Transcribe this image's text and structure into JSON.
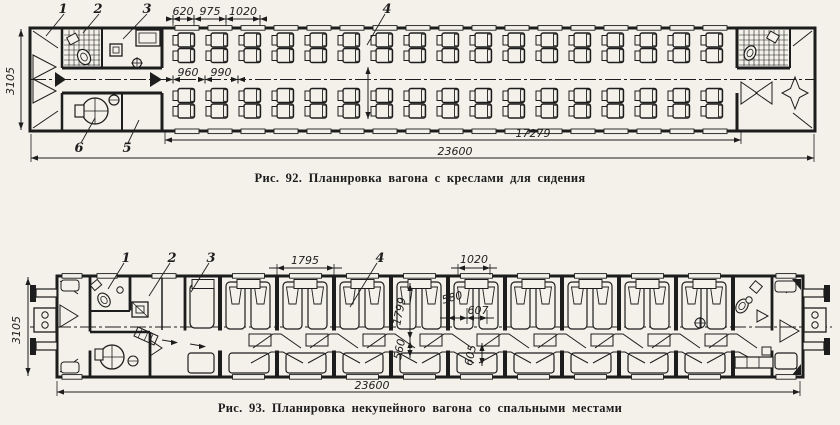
{
  "page_background": "#f3f1ea",
  "ink_color": "#1d1d1d",
  "fig92": {
    "caption": "Рис. 92. Планировка вагона с креслами для сидения",
    "callout_1": "1",
    "callout_2": "2",
    "callout_3": "3",
    "callout_4": "4",
    "callout_5": "5",
    "callout_6": "6",
    "dim_620": "620",
    "dim_975": "975",
    "dim_1020": "1020",
    "dim_960": "960",
    "dim_990": "990",
    "dim_3105": "3105",
    "dim_17279": "17279",
    "dim_23600": "23600"
  },
  "fig93": {
    "caption": "Рис. 93. Планировка некупейного вагона со спальными местами",
    "callout_1": "1",
    "callout_2": "2",
    "callout_3": "3",
    "callout_4": "4",
    "dim_1795": "1795",
    "dim_1020": "1020",
    "dim_580": "580",
    "dim_607": "607",
    "dim_1799": "1799",
    "dim_560": "560",
    "dim_605": "605",
    "dim_3105": "3105",
    "dim_23600": "23600"
  }
}
